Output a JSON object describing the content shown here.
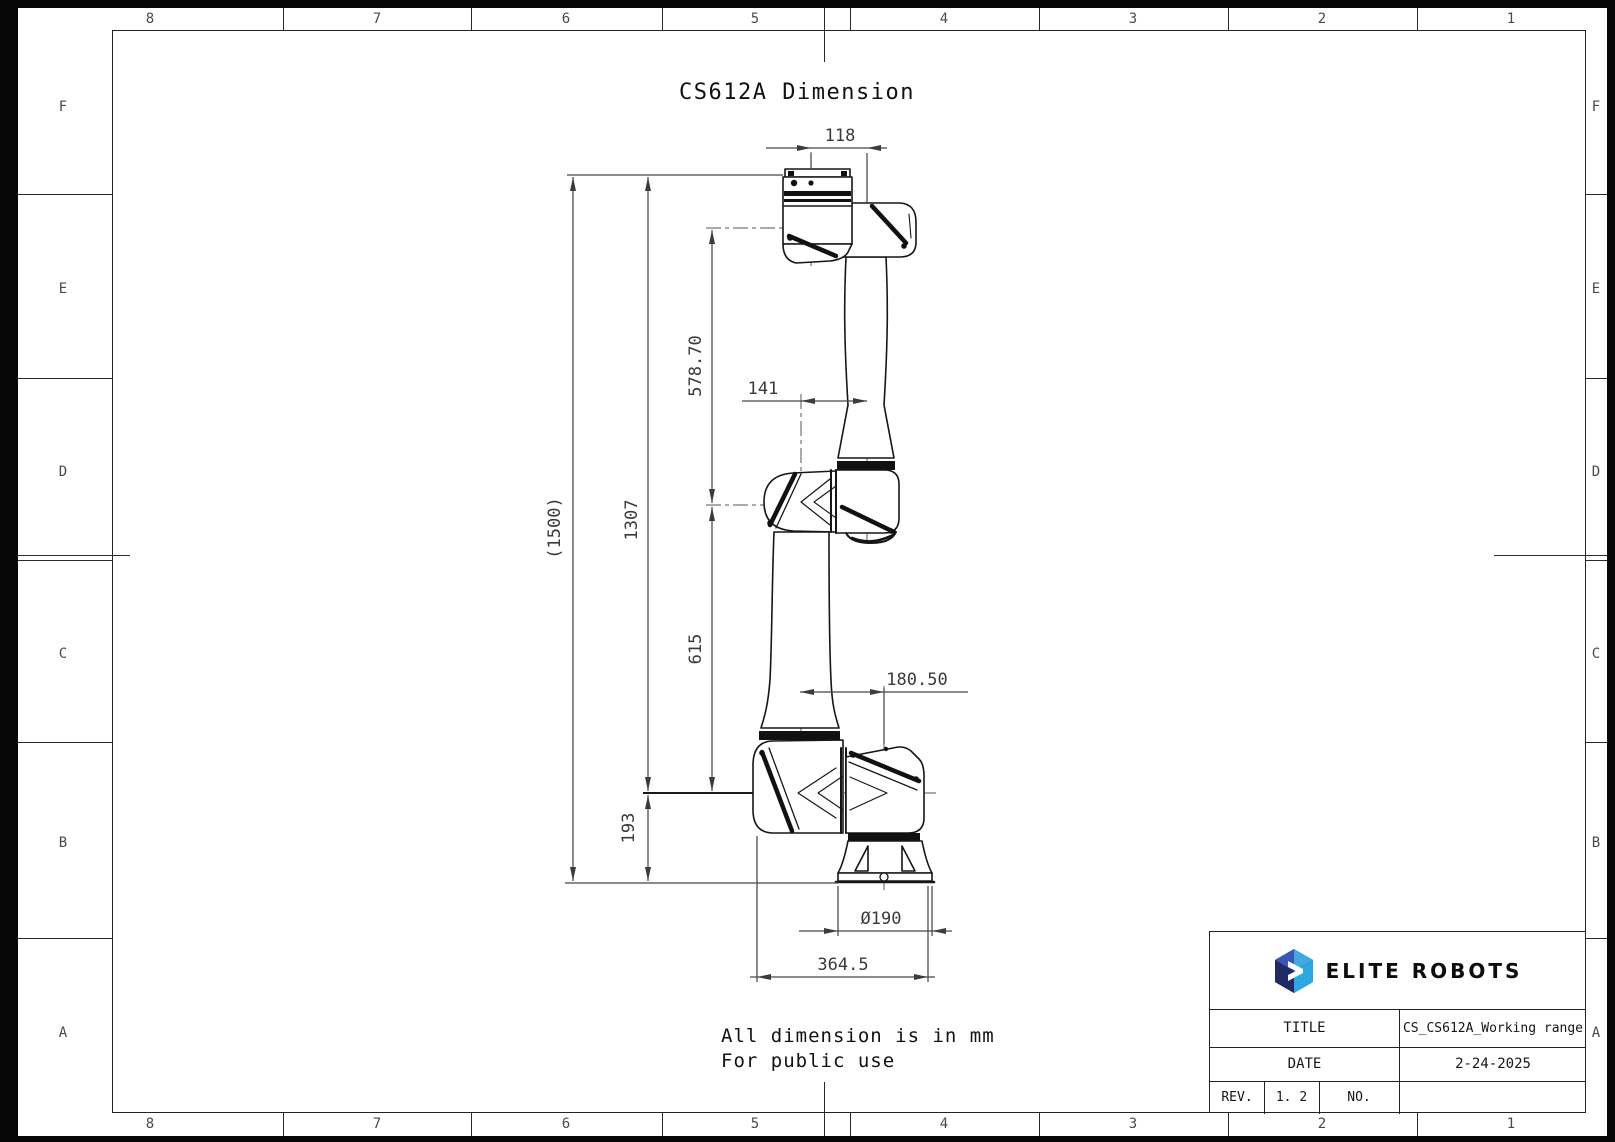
{
  "sheet": {
    "title": "CS612A Dimension",
    "note_line1": "All dimension is in mm",
    "note_line2": "For public use"
  },
  "zones": {
    "cols": [
      "8",
      "7",
      "6",
      "5",
      "4",
      "3",
      "2",
      "1"
    ],
    "rows": [
      "F",
      "E",
      "D",
      "C",
      "B",
      "A"
    ]
  },
  "dims": {
    "d1500": "(1500)",
    "d1307": "1307",
    "d578": "578.70",
    "d615": "615",
    "d193": "193",
    "d118": "118",
    "d141": "141",
    "d180": "180.50",
    "d190": "Ø190",
    "d364": "364.5"
  },
  "title_block": {
    "brand": "ELITE ROBOTS",
    "title_label": "TITLE",
    "title_value": "CS_CS612A_Working range",
    "date_label": "DATE",
    "date_value": "2-24-2025",
    "rev_label": "REV.",
    "rev_value": "1. 2",
    "no_label": "NO.",
    "no_value": ""
  },
  "colors": {
    "logo_navy": "#1f2a66",
    "logo_blue": "#3a57b8",
    "logo_cyan": "#41a9de",
    "line": "#161616",
    "dim": "#3f3f3f"
  }
}
